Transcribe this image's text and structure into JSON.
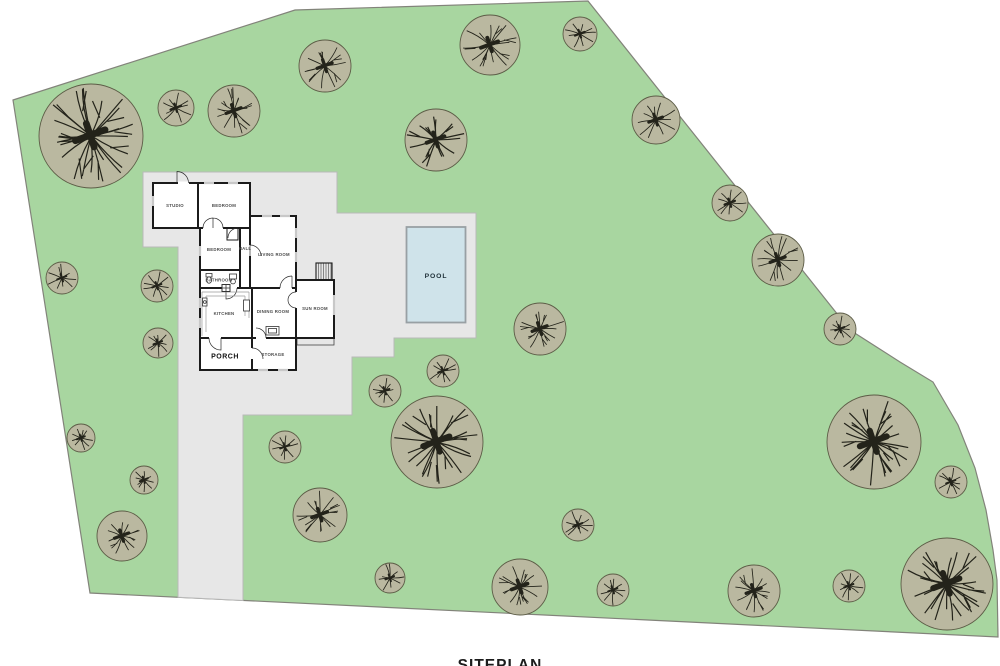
{
  "title": "SITEPLAN",
  "site": {
    "grass_color": "#a8d6a0",
    "boundary_color": "#82837a",
    "paving_color": "#e7e7e7",
    "paving_edge": "#b9b9b9",
    "tree_fill": "#bab8a0",
    "tree_edge": "#5c5c46",
    "tree_branch": "#23231a",
    "trees": [
      {
        "x": 91,
        "y": 136,
        "r": 52
      },
      {
        "x": 176,
        "y": 108,
        "r": 18
      },
      {
        "x": 234,
        "y": 111,
        "r": 26
      },
      {
        "x": 325,
        "y": 66,
        "r": 26
      },
      {
        "x": 490,
        "y": 45,
        "r": 30
      },
      {
        "x": 580,
        "y": 34,
        "r": 17
      },
      {
        "x": 436,
        "y": 140,
        "r": 31
      },
      {
        "x": 656,
        "y": 120,
        "r": 24
      },
      {
        "x": 730,
        "y": 203,
        "r": 18
      },
      {
        "x": 778,
        "y": 260,
        "r": 26
      },
      {
        "x": 840,
        "y": 329,
        "r": 16
      },
      {
        "x": 62,
        "y": 278,
        "r": 16
      },
      {
        "x": 157,
        "y": 286,
        "r": 16
      },
      {
        "x": 158,
        "y": 343,
        "r": 15
      },
      {
        "x": 81,
        "y": 438,
        "r": 14
      },
      {
        "x": 144,
        "y": 480,
        "r": 14
      },
      {
        "x": 122,
        "y": 536,
        "r": 25
      },
      {
        "x": 285,
        "y": 447,
        "r": 16
      },
      {
        "x": 320,
        "y": 515,
        "r": 27
      },
      {
        "x": 385,
        "y": 391,
        "r": 16
      },
      {
        "x": 443,
        "y": 371,
        "r": 16
      },
      {
        "x": 437,
        "y": 442,
        "r": 46
      },
      {
        "x": 390,
        "y": 578,
        "r": 15
      },
      {
        "x": 520,
        "y": 587,
        "r": 28
      },
      {
        "x": 540,
        "y": 329,
        "r": 26
      },
      {
        "x": 578,
        "y": 525,
        "r": 16
      },
      {
        "x": 613,
        "y": 590,
        "r": 16
      },
      {
        "x": 754,
        "y": 591,
        "r": 26
      },
      {
        "x": 849,
        "y": 586,
        "r": 16
      },
      {
        "x": 874,
        "y": 442,
        "r": 47
      },
      {
        "x": 951,
        "y": 482,
        "r": 16
      },
      {
        "x": 947,
        "y": 584,
        "r": 46
      }
    ]
  },
  "pool": {
    "label": "POOL",
    "water_color": "#cfe3ea"
  },
  "house": {
    "rooms": {
      "studio": "STUDIO",
      "bedroom1": "BEDROOM",
      "bedroom2": "BEDROOM",
      "hall": "HALL",
      "living": "LIVING ROOM",
      "bathroom": "BATHROOM",
      "kitchen": "KITCHEN",
      "dining": "DINING ROOM",
      "sunroom": "SUN ROOM",
      "porch": "PORCH",
      "storage": "STORAGE"
    }
  }
}
